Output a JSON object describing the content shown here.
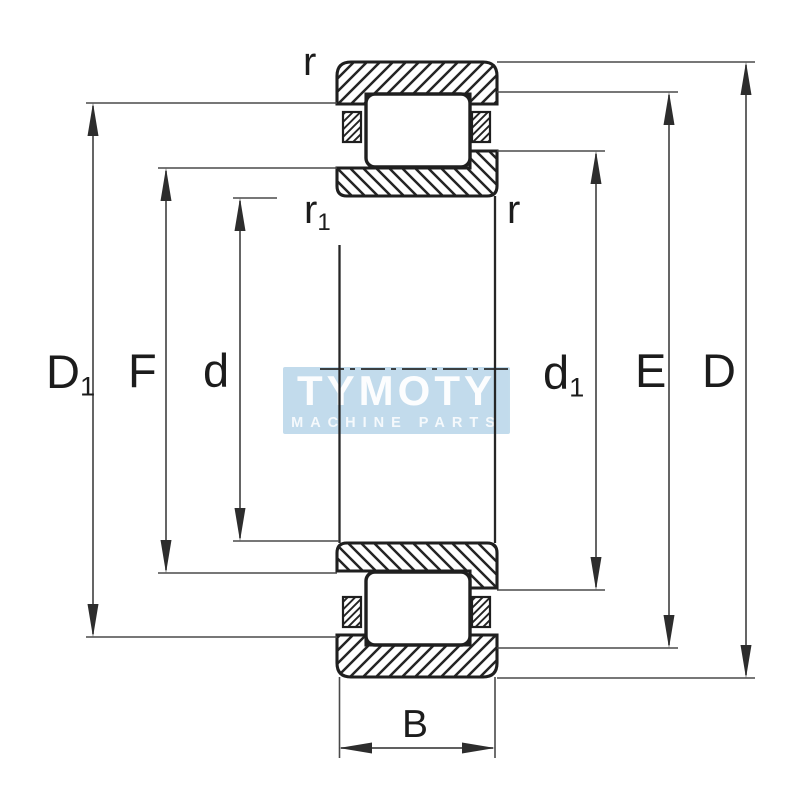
{
  "dims": {
    "D1": {
      "main": "D",
      "sub": "1"
    },
    "F": {
      "main": "F"
    },
    "d": {
      "main": "d"
    },
    "d1": {
      "main": "d",
      "sub": "1"
    },
    "E": {
      "main": "E"
    },
    "D": {
      "main": "D"
    },
    "B": {
      "main": "B"
    },
    "r_top_left": {
      "main": "r"
    },
    "r_inner_left": {
      "main": "r",
      "sub": "1"
    },
    "r_inner_right": {
      "main": "r"
    }
  },
  "watermark": {
    "title": "TYMOTY",
    "subtitle": "MACHINE PARTS"
  },
  "colors": {
    "line": "#1f1f1f",
    "dimension": "#4a4a4a",
    "watermark_bg": "#bed9eb",
    "watermark_text": "#ffffff",
    "background": "#ffffff"
  }
}
